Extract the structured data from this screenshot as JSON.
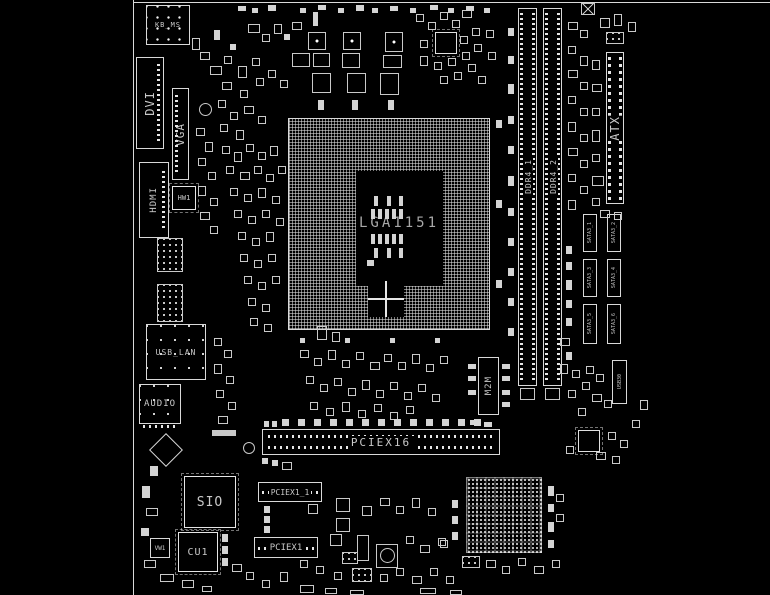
{
  "colors": {
    "background": "#000000",
    "silkscreen": "#e0e0e0"
  },
  "connectors": {
    "kb_ms": "KB_MS",
    "dvi": "DVI",
    "vga": "VGA",
    "hdmi": "HDMI",
    "usb_lan": "USB_LAN",
    "audio": "AUDIO",
    "atx": "ATX",
    "m2m": "M2M",
    "usb3_header": "USB30"
  },
  "slots": {
    "ddr4_1": "DDR4_1",
    "ddr4_2": "DDR4_2",
    "pciex16": "PCIEX16",
    "pciex1_1": "PCIEX1_1",
    "pciex1_2": "PCIEX1"
  },
  "sata": [
    "SATA3_1",
    "SATA3_2",
    "SATA3_3",
    "SATA3_4",
    "SATA3_5",
    "SATA3_6"
  ],
  "chips": {
    "cpu_socket": "LGA1151",
    "sio": "SIO",
    "cu1": "CU1",
    "hw1": "HW1",
    "vw1": "VW1"
  }
}
